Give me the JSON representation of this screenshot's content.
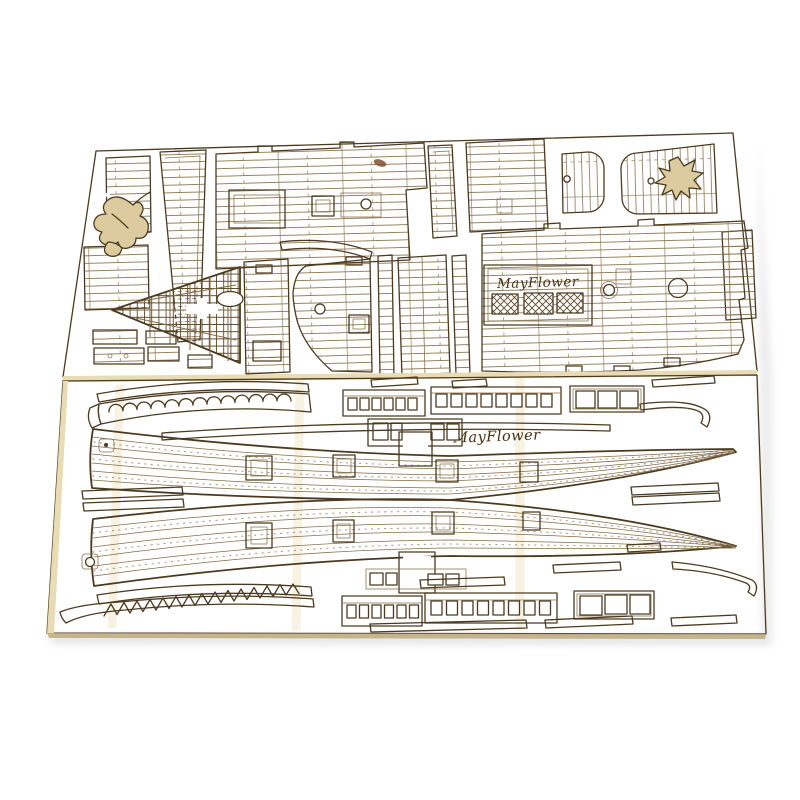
{
  "engravings": {
    "upper_sheet_label": "MayFlower",
    "lower_sheet_label": "MayFlower"
  },
  "colors": {
    "background": "#ffffff",
    "sheet_upper": "#cfbb8c",
    "sheet_lower": "#d4c293",
    "wood_light": "#dccb9e",
    "sheet_edge": "#e9dcb4",
    "sheet_side": "#b9a577",
    "burn": "#4c3a20",
    "engrave": "#846c46",
    "lattice": "#5d4829",
    "cutout": "#ffffff",
    "label": "#452f14",
    "knot": "#7c4a22",
    "shadow": "#bdbdbd"
  }
}
